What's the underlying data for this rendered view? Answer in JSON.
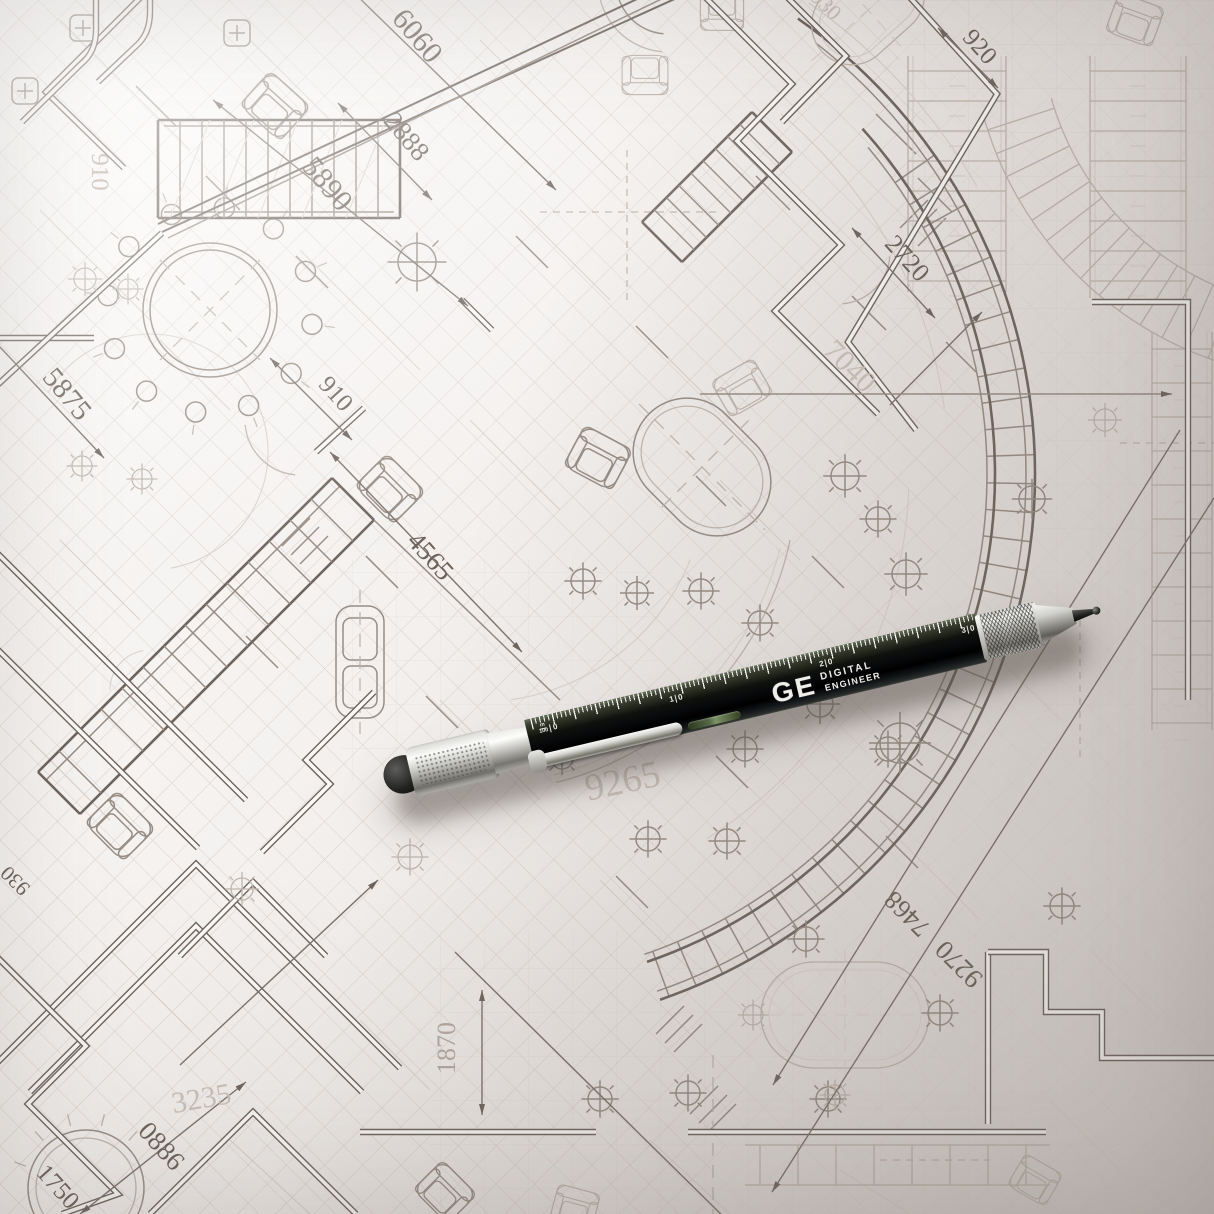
{
  "palette": {
    "paper_hi": "#fbfaf8",
    "paper_mid": "#e9e5e2",
    "paper_lo": "#d9d4d1",
    "ink_dark": "#6e645e",
    "ink_dim": "#7c726b",
    "ink_mid": "#978d85",
    "ink_light": "#bfb6ae",
    "ink_faint": "#d9d2cc",
    "pen_black": "#101208",
    "pen_silver": "#b7b6b1",
    "brand_white": "#efede8",
    "level_green": "#546847",
    "shadow_warm": "#564c44"
  },
  "blueprint": {
    "dimension_labels": [
      "6060",
      "2888",
      "5890",
      "910",
      "5875",
      "910",
      "4565",
      "920",
      "2720",
      "7040",
      "930",
      "9265",
      "7468",
      "9270",
      "1870",
      "3235",
      "0886",
      "1750",
      "930"
    ]
  },
  "pen": {
    "brand": "GE",
    "brand_line1": "DIGITAL",
    "brand_line2": "ENGINEER",
    "scale_unit_top": "m",
    "scale_unit_bottom": "100",
    "scale_zero": "0",
    "marks": [
      {
        "a": "1",
        "b": "0"
      },
      {
        "a": "2",
        "b": "0"
      },
      {
        "a": "3",
        "b": "0"
      }
    ]
  }
}
